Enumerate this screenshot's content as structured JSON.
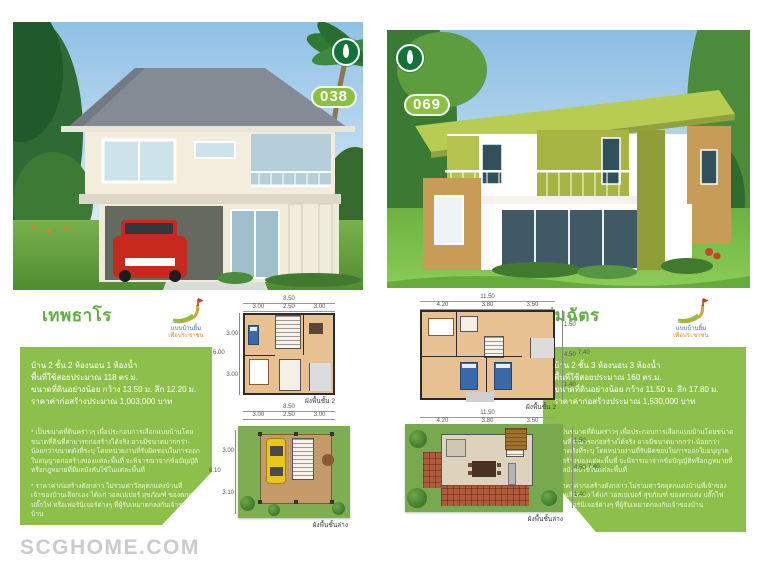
{
  "page": {
    "watermark": "SCGHOME.COM"
  },
  "brand": {
    "program_line1": "แบบบ้านยิ้ม",
    "program_line2": "เพื่อประชาชน"
  },
  "colors": {
    "accent_green": "#8dc04a",
    "title_green": "#64ad44",
    "badge_green": "#8cc043",
    "watermark_gray": "#cbcbcb"
  },
  "panels": [
    {
      "badge": "038",
      "title": "เทพธาโร",
      "specs": [
        "บ้าน 2 ชั้น 2 ห้องนอน 1 ห้องน้ำ",
        "พื้นที่ใช้สอยประมาณ 118 ตร.ม.",
        "ขนาดที่ดินอย่างน้อย กว้าง 13.50 ม. ลึก 12.20 ม.",
        "ราคาค่าก่อสร้างประมาณ 1,003,000 บาท"
      ],
      "disclaimers": [
        "* เป็นขนาดที่ดินคร่าวๆ เพื่อประกอบการเลือกแบบบ้านโดยขนาดที่ดินที่สามารถก่อสร้างได้จริง อาจมีขนาดมากกว่า-น้อยกว่าขนาดดังที่ระบุ โดยหน่วยงานที่รับผิดชอบในการออกใบอนุญาตก่อสร้างของแต่ละพื้นที่ จะพิจารณาจากข้อบัญญัติหรือกฎหมายที่มีผลบังคับใช้ในแต่ละพื้นที่",
        "* ราคาค่าก่อสร้างดังกล่าว ไม่รวมค่าวัสดุตกแต่งบ้านที่เจ้าของบ้านเลือกเอง ได้แก่ วอลเปเปอร์ สุขภัณฑ์ ของตกแต่ง ปลั๊กไฟ หรือเฟอร์นิเจอร์ต่างๆ ที่ผู้รับเหมาตกลงกับเจ้าของบ้าน"
      ],
      "plan2": {
        "caption": "ผังพื้นชั้น 2",
        "top_total": "8.50",
        "top_segs": [
          "3.00",
          "2.50",
          "3.00"
        ],
        "side_total": "6.00",
        "side_segs": [
          "3.00",
          "3.00"
        ],
        "bottom_total": "8.50",
        "bottom_segs": [
          "3.00",
          "2.50",
          "3.00"
        ]
      },
      "plan1": {
        "caption": "ผังพื้นชั้นล่าง",
        "side_total": "6.10",
        "side_segs": [
          "3.00",
          "3.10"
        ]
      }
    },
    {
      "badge": "069",
      "title": "ร่มฉัตร",
      "specs": [
        "บ้าน 2 ชั้น 3 ห้องนอน 3 ห้องน้ำ",
        "พื้นที่ใช้สอยประมาณ 160 ตร.ม.",
        "ขนาดที่ดินอย่างน้อย กว้าง 11.50 ม. ลึก 17.80 ม.",
        "ราคาค่าก่อสร้างประมาณ 1,530,000 บาท"
      ],
      "disclaimers": [
        "* เป็นขนาดที่ดินคร่าวๆ เพื่อประกอบการเลือกแบบบ้านโดยขนาดที่ดินที่สามารถก่อสร้างได้จริง อาจมีขนาดมากกว่า-น้อยกว่าขนาดดังที่ระบุ โดยหน่วยงานที่รับผิดชอบในการออกใบอนุญาตก่อสร้างของแต่ละพื้นที่ จะพิจารณาจากข้อบัญญัติหรือกฎหมายที่มีผลบังคับใช้ในแต่ละพื้นที่",
        "* ราคาค่าก่อสร้างดังกล่าว ไม่รวมค่าวัสดุตกแต่งบ้านที่เจ้าของบ้านเลือกเอง ได้แก่ วอลเปเปอร์ สุขภัณฑ์ ของตกแต่ง ปลั๊กไฟ หรือเฟอร์นิเจอร์ต่างๆ ที่ผู้รับเหมาตกลงกับเจ้าของบ้าน"
      ],
      "plan2": {
        "caption": "ผังพื้นชั้น 2",
        "top_total": "11.50",
        "top_segs": [
          "4.20",
          "3.80",
          "3.50"
        ],
        "side_total": "7.40",
        "side_segs": [
          "1.50",
          "4.50",
          "1.40"
        ],
        "bottom_total": "11.50",
        "bottom_segs": [
          "4.20",
          "3.80",
          "3.50"
        ]
      },
      "plan1": {
        "caption": "ผังพื้นชั้นล่าง",
        "side_total": "7.40",
        "side_segs": [
          "1.50",
          "4.50",
          "1.40"
        ]
      }
    }
  ]
}
